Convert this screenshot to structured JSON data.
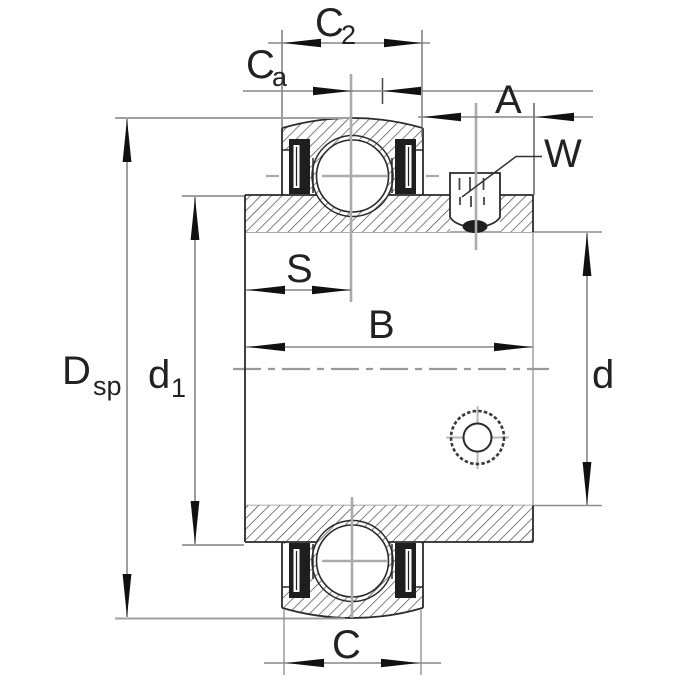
{
  "drawing": {
    "labels": {
      "c2": {
        "base": "C",
        "sub": "2"
      },
      "ca": {
        "base": "C",
        "sub": "a"
      },
      "a": "A",
      "w": "W",
      "s": "S",
      "b": "B",
      "dsp": {
        "base": "D",
        "sub": "sp"
      },
      "d1": {
        "base": "d",
        "sub": "1"
      },
      "d": "d",
      "c": "C"
    },
    "colors": {
      "outline": "#2a2a2a",
      "hatch": "#3d3d3d",
      "dimension_line": "#858585",
      "extension_line": "#8a8a8a",
      "centerline": "#ababab",
      "arrowhead": "#111111",
      "seal": "#1e1e1e",
      "background": "#ffffff"
    }
  }
}
